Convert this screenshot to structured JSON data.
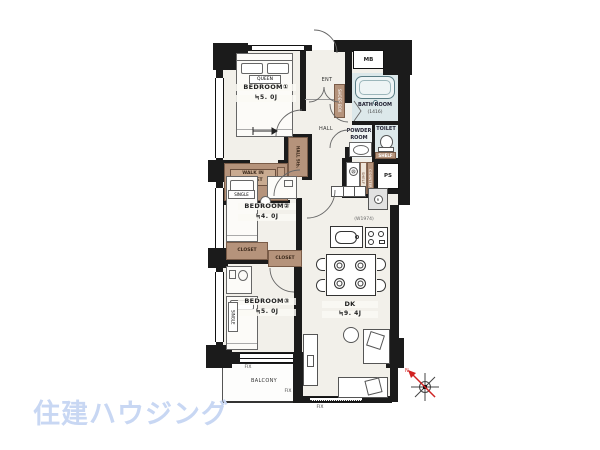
{
  "brand": {
    "logo": "住建ハウジング"
  },
  "rooms": {
    "bedroom1": {
      "name": "BEDROOM①",
      "size": "≒5. 0J"
    },
    "bedroom2": {
      "name": "BEDROOM②",
      "size": "≒4. 0J"
    },
    "bedroom3": {
      "name": "BEDROOM③",
      "size": "≒5. 0J"
    },
    "dk": {
      "name": "DK",
      "size": "≒9. 4J"
    },
    "hall": {
      "name": "HALL"
    },
    "entrance": {
      "name": "ENT"
    },
    "balcony": {
      "name": "BALCONY"
    },
    "bathroom": {
      "name": "BATH ROOM",
      "size": "(1416)"
    },
    "powder_room": {
      "line1": "POWDER",
      "line2": "ROOM"
    },
    "toilet": {
      "name": "TOILET"
    }
  },
  "storage": {
    "walk_in_closet": {
      "line1": "WALK IN",
      "line2": "CLOSET"
    },
    "hall_storage": "HALL Stb.",
    "closet_left": "CLOSET",
    "closet_right": "CLOSET",
    "shoes_box": "SHOES BOX",
    "toilet_shelf": "SHELF",
    "shelf_column": "SHELF",
    "counter_column": "COUNTER"
  },
  "fixtures": {
    "meter_box": "MB",
    "pipe_space": "PS",
    "washer_symbol": "W",
    "fridge_symbol": "R",
    "kitchen_width": "(W1974)"
  },
  "furniture": {
    "queen_bed": "QUEEN",
    "single_bed_2": "SINGLE",
    "single_bed_3": "SINGLE"
  },
  "windows": {
    "fix_1": "FIX",
    "fix_2": "FIX",
    "fix_3": "FIX"
  },
  "compass": {
    "north": "N"
  },
  "colors": {
    "wall": "#1b1b1b",
    "floor": "#f2f0ea",
    "wet": "#dce8ea",
    "wood": "#b5937b",
    "logo_blue": "#c8d7f3",
    "north_red": "#d22222"
  }
}
